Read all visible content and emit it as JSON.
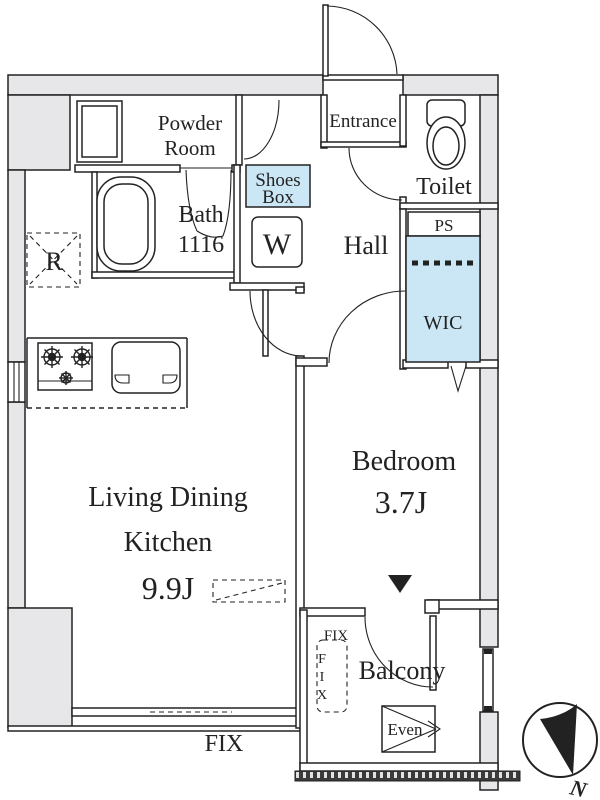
{
  "title": "Apartment floor plan",
  "colors": {
    "wall_fill": "#e7e7e9",
    "line": "#222222",
    "closet_fill": "#cbe7f5",
    "hatch_fill": "#3b3b3b",
    "text": "#222222"
  },
  "rooms": {
    "powder_room": {
      "label_line1": "Powder",
      "label_line2": "Room"
    },
    "bath": {
      "label": "Bath",
      "size": "1116"
    },
    "shoes_box": {
      "label_line1": "Shoes",
      "label_line2": "Box"
    },
    "washer": {
      "label": "W"
    },
    "refrigerator": {
      "label": "R"
    },
    "entrance": {
      "label": "Entrance"
    },
    "toilet": {
      "label": "Toilet"
    },
    "pipe_space": {
      "label": "PS"
    },
    "hall": {
      "label": "Hall"
    },
    "wic": {
      "label": "WIC"
    },
    "ldk": {
      "label_line1": "Living Dining",
      "label_line2": "Kitchen",
      "area": "9.9J"
    },
    "bedroom": {
      "label": "Bedroom",
      "area": "3.7J"
    },
    "balcony": {
      "label": "Balcony",
      "hatch_label": "Even",
      "fix_label": "FIX",
      "fix_letters": [
        "F",
        "I",
        "X"
      ]
    }
  },
  "annotations": {
    "fix_window": "FIX",
    "north": "N"
  }
}
